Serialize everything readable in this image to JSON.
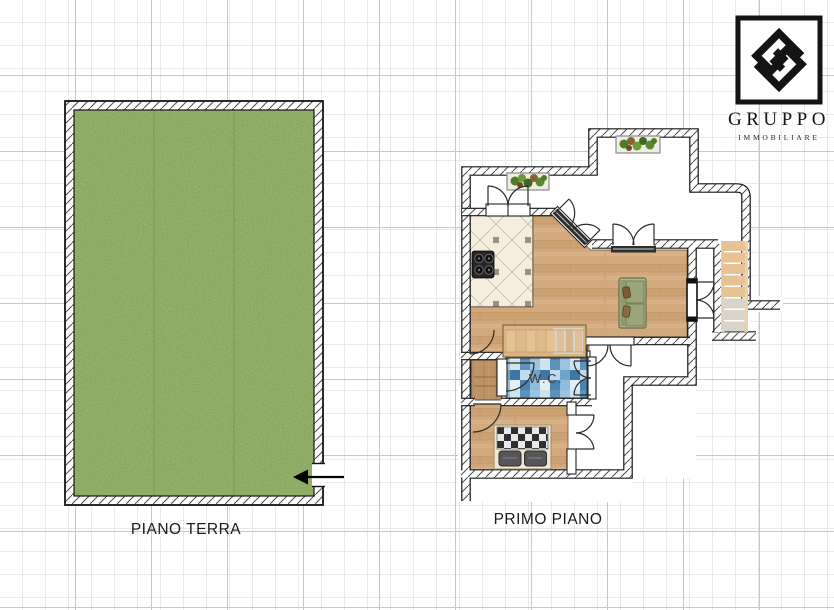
{
  "canvas": {
    "width": 834,
    "height": 610,
    "background": "#ffffff"
  },
  "logo": {
    "brand": "GRUPPO",
    "tagline": "IMMOBILIARE",
    "ink": "#141414"
  },
  "plans": {
    "ground_floor": {
      "label": "PIANO TERRA",
      "surface": "garden",
      "entrance_arrow": "left"
    },
    "first_floor": {
      "label": "PRIMO PIANO",
      "wc_label": "W.C."
    }
  },
  "palette": {
    "grass": "#7fa450",
    "wood": "#d2a97c",
    "kitchen_tile": "#f6eedd",
    "wc_mosaic": "#85b7d9",
    "stair_wood": "#e5c193",
    "wall_ink": "#1a1a1a",
    "grid_minor": "#e9e9e9",
    "grid_major": "#c7c7c7"
  }
}
